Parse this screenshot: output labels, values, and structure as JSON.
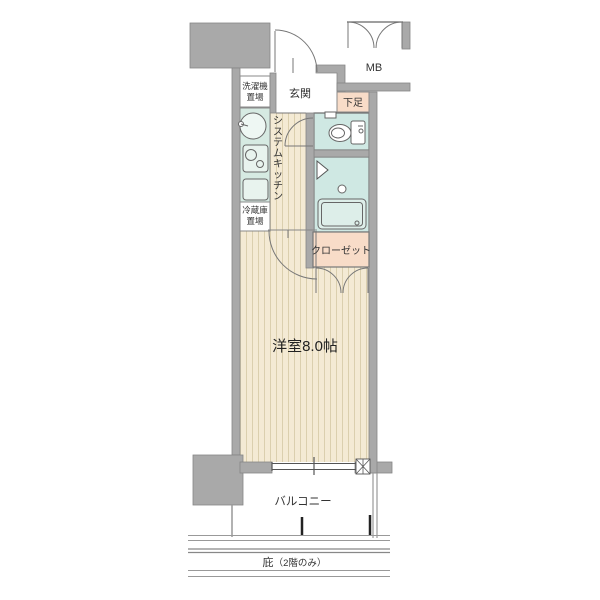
{
  "floorplan": {
    "labels": {
      "genkan": "玄関",
      "mb": "MB",
      "shoe_box": "下足",
      "washer_line1": "洗濯機",
      "washer_line2": "置場",
      "kitchen_vertical": "システムキッチン",
      "fridge_line1": "冷蔵庫",
      "fridge_line2": "置場",
      "closet": "クローゼット",
      "main_room": "洋室8.0帖",
      "balcony": "バルコニー",
      "eaves": "庇",
      "eaves_note": "（2階のみ）"
    },
    "colors": {
      "wall": "#a9a9a9",
      "floor_wood": "#f4ead4",
      "wet_area": "#cfe8e3",
      "kitchen_counter": "#d6eae2",
      "accent_pink": "#f8dcc8",
      "line": "#666666"
    }
  }
}
